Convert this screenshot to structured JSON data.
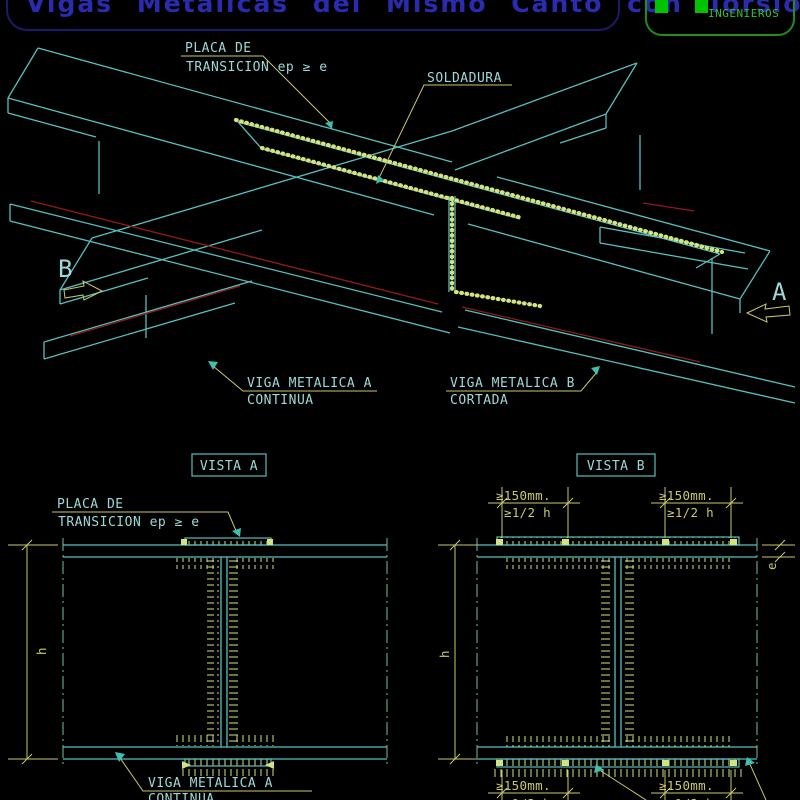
{
  "title": {
    "text": "Vigas Metalicas del Mismo Canto con Torsion"
  },
  "logo": {
    "name": "INGENIEROS"
  },
  "iso": {
    "placa_label": {
      "line1": "PLACA DE",
      "line2": "TRANSICION ep ≥ e"
    },
    "soldadura_label": "SOLDADURA",
    "viga_a_label": {
      "line1": "VIGA METALICA A",
      "line2": "CONTINUA"
    },
    "viga_b_label": {
      "line1": "VIGA METALICA B",
      "line2": "CORTADA"
    },
    "marker_b": "B",
    "marker_a": "A"
  },
  "vista_a": {
    "title": "VISTA A",
    "placa_label": {
      "line1": "PLACA DE",
      "line2": "TRANSICION ep ≥ e"
    },
    "viga_label": {
      "line1": "VIGA METALICA A",
      "line2": "CONTINUA"
    },
    "dim_h": "h"
  },
  "vista_b": {
    "title": "VISTA B",
    "dim_150": "≥150mm.",
    "dim_half_h": "≥1/2 h",
    "dim_e": "e",
    "dim_h": "h"
  },
  "colors": {
    "background": "#000000",
    "line_cyan": "#58BFBF",
    "text_cyan": "#9ED8D8",
    "dim_yellow": "#C9C96E",
    "weld_yellow": "#D3E37E",
    "fillet_red": "#8F1B1B",
    "centerline_green": "#6FC2A8",
    "title_blue": "#2B2BB0",
    "logo_green": "#2FC32F"
  }
}
